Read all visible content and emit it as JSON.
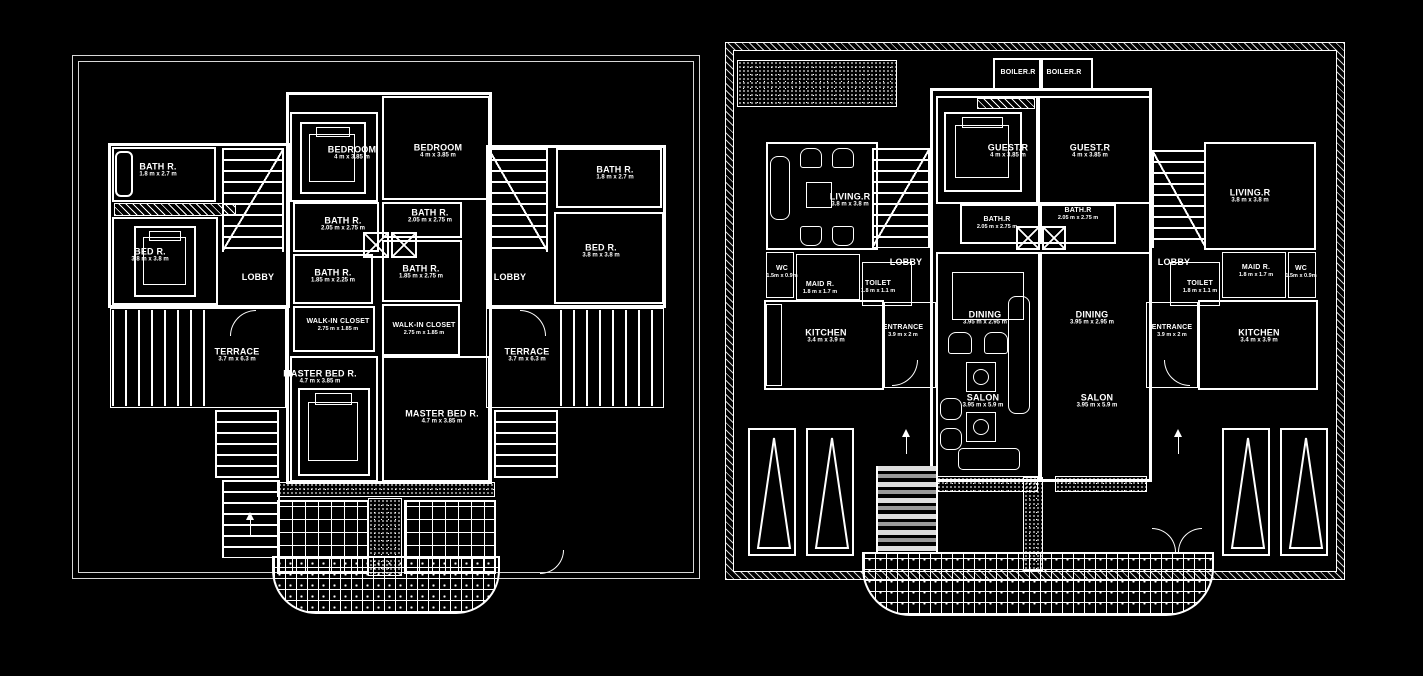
{
  "drawing": {
    "background": "#000000",
    "line_color": "#ffffff",
    "type": "architectural-floor-plan",
    "sheets": [
      "first-floor-plan",
      "ground-floor-plan"
    ]
  },
  "plans": [
    {
      "name": "first-floor-plan",
      "rooms": [
        {
          "label": "BATH R.",
          "dims": "1.8 m x 2.7 m"
        },
        {
          "label": "BED R.",
          "dims": "3.8 m x 3.8 m"
        },
        {
          "label": "LOBBY",
          "dims": ""
        },
        {
          "label": "BEDROOM",
          "dims": "4 m x 3.85 m"
        },
        {
          "label": "BEDROOM",
          "dims": "4 m x 3.85 m"
        },
        {
          "label": "BATH R.",
          "dims": "2.05 m x 2.75 m"
        },
        {
          "label": "BATH R.",
          "dims": "2.05 m x 2.75 m"
        },
        {
          "label": "BATH R.",
          "dims": "1.85 m x 2.25 m"
        },
        {
          "label": "BATH R.",
          "dims": "1.85 m x 2.75 m"
        },
        {
          "label": "WALK-IN CLOSET",
          "dims": "2.75 m x 1.85 m"
        },
        {
          "label": "WALK-IN CLOSET",
          "dims": "2.75 m x 1.85 m"
        },
        {
          "label": "MASTER BED R.",
          "dims": "4.7 m x 3.85 m"
        },
        {
          "label": "MASTER BED R.",
          "dims": "4.7 m x 3.85 m"
        },
        {
          "label": "LOBBY",
          "dims": ""
        },
        {
          "label": "BATH R.",
          "dims": "1.8 m x 2.7 m"
        },
        {
          "label": "BED R.",
          "dims": "3.8 m x 3.8 m"
        },
        {
          "label": "TERRACE",
          "dims": "3.7 m x 6.3 m"
        },
        {
          "label": "TERRACE",
          "dims": "3.7 m x 6.3 m"
        }
      ]
    },
    {
      "name": "ground-floor-plan",
      "rooms": [
        {
          "label": "BOILER.R",
          "dims": ""
        },
        {
          "label": "BOILER.R",
          "dims": ""
        },
        {
          "label": "GUEST.R",
          "dims": "4 m x 3.85 m"
        },
        {
          "label": "GUEST.R",
          "dims": "4 m x 3.85 m"
        },
        {
          "label": "LIVING.R",
          "dims": "3.8 m x 3.8 m"
        },
        {
          "label": "LIVING.R",
          "dims": "3.8 m x 3.8 m"
        },
        {
          "label": "BATH.R",
          "dims": "2.05 m x 2.75 m"
        },
        {
          "label": "BATH.R",
          "dims": "2.05 m x 2.75 m"
        },
        {
          "label": "LOBBY",
          "dims": ""
        },
        {
          "label": "LOBBY",
          "dims": ""
        },
        {
          "label": "WC",
          "dims": "1.5m x 0.9m"
        },
        {
          "label": "WC",
          "dims": "1.5m x 0.9m"
        },
        {
          "label": "MAID R.",
          "dims": "1.8 m x 1.7 m"
        },
        {
          "label": "MAID R.",
          "dims": "1.8 m x 1.7 m"
        },
        {
          "label": "TOILET",
          "dims": "1.8 m x 1.1 m"
        },
        {
          "label": "TOILET",
          "dims": "1.8 m x 1.1 m"
        },
        {
          "label": "KITCHEN",
          "dims": "3.4 m x 3.9 m"
        },
        {
          "label": "KITCHEN",
          "dims": "3.4 m x 3.9 m"
        },
        {
          "label": "ENTRANCE",
          "dims": "3.9 m x 2 m"
        },
        {
          "label": "ENTRANCE",
          "dims": "3.9 m x 2 m"
        },
        {
          "label": "DINING",
          "dims": "3.95 m x 2.95 m"
        },
        {
          "label": "DINING",
          "dims": "3.95 m x 2.95 m"
        },
        {
          "label": "SALON",
          "dims": "3.95 m x 5.9 m"
        },
        {
          "label": "SALON",
          "dims": "3.95 m x 5.9 m"
        }
      ]
    }
  ]
}
